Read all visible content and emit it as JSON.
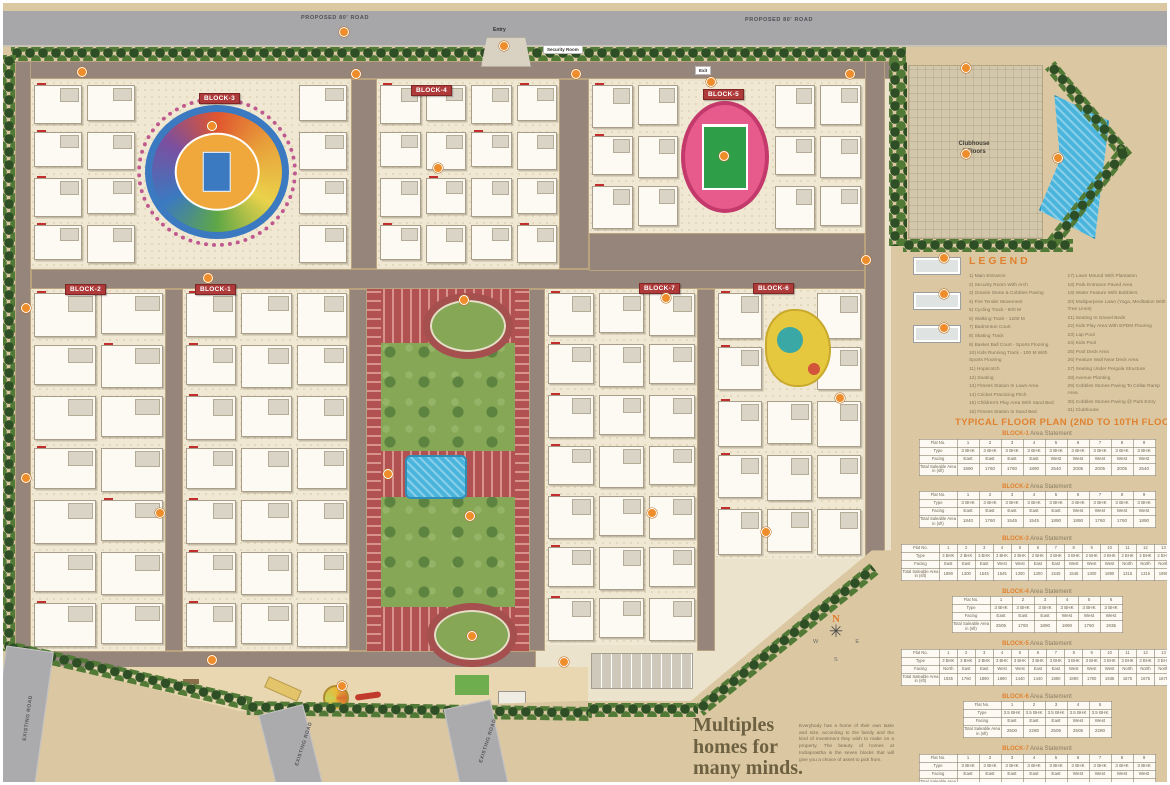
{
  "map": {
    "roads": {
      "proposed_top_left": "PROPOSED 80' ROAD",
      "proposed_top_right": "PROPOSED 80' ROAD",
      "existing_left": "EXISTING ROAD",
      "existing_bottom_1": "EXISTING ROAD",
      "existing_bottom_2": "EXISTING ROAD"
    },
    "entry_label": "Entry",
    "exit_label": "Exit",
    "security_room_label": "Security Room",
    "clubhouse_label": "Clubhouse",
    "clubhouse_floors": "5 Floors",
    "block_labels": {
      "b1": "BLOCK-1",
      "b2": "BLOCK-2",
      "b3": "BLOCK-3",
      "b4": "BLOCK-4",
      "b5": "BLOCK-5",
      "b6": "BLOCK-6",
      "b7": "BLOCK-7"
    },
    "compass": {
      "n": "N",
      "e": "E",
      "s": "S",
      "w": "W"
    }
  },
  "legend": {
    "title": "LEGEND",
    "items_col1": [
      "1) Main Entrance",
      "2) Security Room With Arch",
      "3) Granite Stone & Cobbles Paving",
      "4) Fire Tender Movement",
      "5) Cycling Track - 900 M",
      "6) Walking Track - 1200 M",
      "7) Badminton Court",
      "8) Skating Track",
      "9) Basket Ball Court - Sports Flooring",
      "10) Kids Running Track - 100 M With Sports Flooring",
      "11) Hopscotch",
      "12) Seating",
      "13) Fitness Station In Lawn Area",
      "14) Cricket Practicing Pitch",
      "15) Children's Play Area With Sand Bed",
      "16) Fitness Station In Sand Bed"
    ],
    "items_col2": [
      "17) Lawn Mound With Plantation",
      "18) Park Entrance Paved Area",
      "19) Water Feature With Bubblers",
      "20) Multipurpose Lawn (Yoga, Meditation With Tree Lines)",
      "21) Seating In Gravel Beds",
      "22) Kids Play Area With EPDM Flooring",
      "23) Lap Pool",
      "24) Kids Pool",
      "25) Pool Deck Area",
      "26) Feature Wall Near Deck Area",
      "27) Seating Under Pergola Structure",
      "28) Avenue Planting",
      "29) Cobbles Stones Paving To Cellar Ramp Area",
      "30) Cobbles Stones Paving @ Park Entry",
      "31) Clubhouse"
    ]
  },
  "floor_plan": {
    "title": "TYPICAL FLOOR PLAN (2ND TO 10TH FLOOR)",
    "subtitle_suffix": "Area Statement",
    "row_headers": [
      "Flat No.",
      "Type",
      "Facing",
      "Total Saleable Area in (sft)"
    ],
    "blocks": [
      {
        "name": "BLOCK-1",
        "flat_no": [
          "1",
          "2",
          "3",
          "4",
          "5",
          "6",
          "7",
          "8",
          "9"
        ],
        "type": [
          "3 BHK",
          "3 BHK",
          "3 BHK",
          "3 BHK",
          "3 BHK",
          "3 BHK",
          "3 BHK",
          "3 BHK",
          "3 BHK"
        ],
        "facing": [
          "East",
          "East",
          "East",
          "East",
          "West",
          "West",
          "West",
          "West",
          "West"
        ],
        "area": [
          "1890",
          "1760",
          "1760",
          "1890",
          "2540",
          "2005",
          "2005",
          "2005",
          "2540"
        ]
      },
      {
        "name": "BLOCK-2",
        "flat_no": [
          "1",
          "2",
          "3",
          "4",
          "5",
          "6",
          "7",
          "8",
          "9"
        ],
        "type": [
          "3 BHK",
          "3 BHK",
          "3 BHK",
          "3 BHK",
          "3 BHK",
          "3 BHK",
          "3 BHK",
          "3 BHK",
          "3 BHK"
        ],
        "facing": [
          "East",
          "East",
          "East",
          "East",
          "East",
          "West",
          "West",
          "West",
          "West"
        ],
        "area": [
          "1840",
          "1760",
          "1545",
          "1545",
          "1890",
          "1890",
          "1760",
          "1760",
          "1890"
        ]
      },
      {
        "name": "BLOCK-3",
        "flat_no": [
          "1",
          "2",
          "3",
          "4",
          "5",
          "6",
          "7",
          "8",
          "9",
          "10",
          "11",
          "12",
          "13"
        ],
        "type": [
          "3 BHK",
          "2 BHK",
          "3 BHK",
          "3 BHK",
          "2 BHK",
          "2 BHK",
          "3 BHK",
          "3 BHK",
          "2 BHK",
          "3 BHK",
          "2 BHK",
          "2 BHK",
          "2 BHK"
        ],
        "facing": [
          "East",
          "East",
          "East",
          "West",
          "West",
          "East",
          "East",
          "West",
          "West",
          "West",
          "North",
          "North",
          "North"
        ],
        "area": [
          "1890",
          "1300",
          "1545",
          "1545",
          "1300",
          "1300",
          "1545",
          "1545",
          "1300",
          "1890",
          "1315",
          "1315",
          "1890"
        ]
      },
      {
        "name": "BLOCK-4",
        "flat_no": [
          "1",
          "2",
          "3",
          "4",
          "5",
          "6"
        ],
        "type": [
          "3 BHK",
          "3 BHK",
          "3 BHK",
          "3 BHK",
          "3 BHK",
          "3 BHK"
        ],
        "facing": [
          "East",
          "East",
          "East",
          "West",
          "West",
          "West"
        ],
        "area": [
          "2505",
          "1760",
          "1890",
          "1890",
          "1760",
          "1935"
        ]
      },
      {
        "name": "BLOCK-5",
        "flat_no": [
          "1",
          "2",
          "3",
          "4",
          "5",
          "6",
          "7",
          "8",
          "9",
          "10",
          "11",
          "12",
          "13"
        ],
        "type": [
          "3 BHK",
          "3 BHK",
          "3 BHK",
          "3 BHK",
          "3 BHK",
          "3 BHK",
          "3 BHK",
          "3 BHK",
          "3 BHK",
          "3 BHK",
          "3 BHK",
          "3 BHK",
          "3 BHK"
        ],
        "facing": [
          "North",
          "East",
          "East",
          "West",
          "West",
          "East",
          "East",
          "West",
          "West",
          "West",
          "North",
          "North",
          "North"
        ],
        "area": [
          "1935",
          "1760",
          "1890",
          "1890",
          "1440",
          "1440",
          "1890",
          "1890",
          "1760",
          "1935",
          "1675",
          "1675",
          "1675"
        ]
      },
      {
        "name": "BLOCK-6",
        "flat_no": [
          "1",
          "2",
          "3",
          "4",
          "5"
        ],
        "type": [
          "3.5 BHK",
          "3.5 BHK",
          "3.5 BHK",
          "3.5 BHK",
          "3.5 BHK"
        ],
        "facing": [
          "East",
          "East",
          "East",
          "West",
          "West"
        ],
        "area": [
          "2500",
          "2280",
          "2505",
          "2505",
          "2280"
        ]
      },
      {
        "name": "BLOCK-7",
        "flat_no": [
          "1",
          "2",
          "3",
          "4",
          "5",
          "6",
          "7",
          "8",
          "9"
        ],
        "type": [
          "3 BHK",
          "3 BHK",
          "3 BHK",
          "3 BHK",
          "3 BHK",
          "3 BHK",
          "3 BHK",
          "3 BHK",
          "3 BHK"
        ],
        "facing": [
          "East",
          "East",
          "East",
          "East",
          "East",
          "West",
          "West",
          "West",
          "West"
        ],
        "area": [
          "2140",
          "2005",
          "2005",
          "2005",
          "2140",
          "1890",
          "1760",
          "1760",
          "1760"
        ]
      }
    ]
  },
  "tagline": {
    "heading_line1": "Multiples",
    "heading_line2": "homes for",
    "heading_line3": "many minds.",
    "body": "Everybody has a home of their own taste and size, according to the family and the kind of investment they wish to make on a property. The beauty of homes at Indraprastha is the seven blocks that will give you a choice of asset to pick from."
  },
  "colors": {
    "accent_orange": "#e0812f",
    "block_badge_red": "#ae3a3a",
    "sand": "#dbc8a2",
    "lawn_green": "#86a756",
    "pool_blue": "#49b4dc",
    "road_gray": "#a7a6a9",
    "internal_road_brown": "#95857a",
    "red_paving": "#b25151"
  }
}
